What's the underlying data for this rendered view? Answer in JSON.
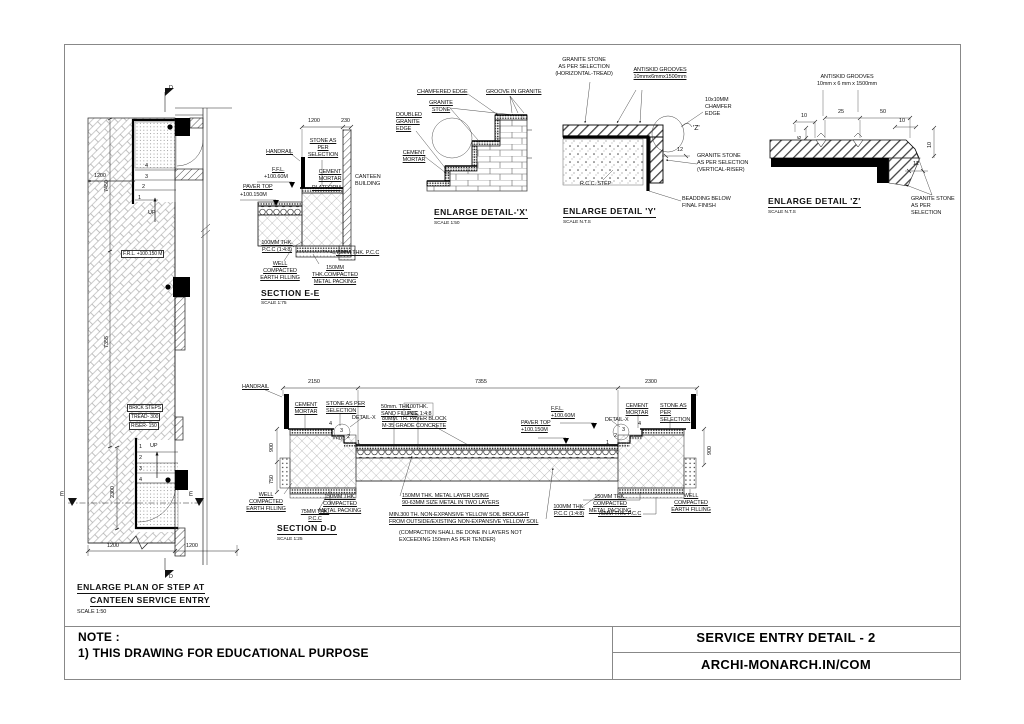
{
  "note": {
    "heading": "NOTE :",
    "line1": "1) THIS DRAWING FOR EDUCATIONAL PURPOSE"
  },
  "titleblock": {
    "title": "SERVICE ENTRY DETAIL - 2",
    "website": "ARCHI-MONARCH.IN/COM"
  },
  "plan": {
    "title1": "ENLARGE PLAN OF STEP AT",
    "title2": "CANTEEN SERVICE ENTRY",
    "scale": "SCALE 1:50",
    "d_top": "D",
    "d_bottom": "D",
    "e_left": "E",
    "e_right": "E",
    "dim_7450": "7450",
    "dim_1200": "1200",
    "dim_7355": "7355",
    "dim_2300": "2300",
    "dim_1200_a": "1200",
    "dim_1200_b": "1200",
    "up1": "UP",
    "up2": "UP",
    "frl": "F.R.L. +100.150 M",
    "brick": "BRICK STEPS",
    "tread": "TREAD- 300",
    "riser": "RISER- 150",
    "n1": "1",
    "n2": "2",
    "n3": "3",
    "n4": "4",
    "m1": "1",
    "m2": "2",
    "m3": "3",
    "m4": "4"
  },
  "see": {
    "title": "SECTION E-E",
    "scale": "SCALE 1:75",
    "dim1200": "1200",
    "dim230": "230",
    "handrail": "HANDRAIL",
    "stone": "STONE AS\nPER\nSELECTION",
    "ffl": "F.F.L.",
    "ffl_v": "+100.60M",
    "paver": "PAVER TOP",
    "paver_v": "+100.150M",
    "cement": "CEMENT\nMORTAR",
    "platform": "PLATFORM",
    "canteen": "CANTEEN\nBUILDING",
    "pcc100": "100MM THK.\nP.C.C (1:4:8)",
    "earth": "WELL COMPACTED\nEARTH FILLING",
    "pcc75": "75MM THK. P.C.C",
    "metal": "150MM THK.COMPACTED\nMETAL PACKING"
  },
  "dx": {
    "title": "ENLARGE DETAIL-'X'",
    "scale": "SCALE 1:50",
    "chamfered": "CHAMFERED EDGE",
    "groove": "GROOVE IN GRANITE",
    "granite": "GRANITE\nSTONE",
    "doubled": "DOUBLED\nGRANITE\nEDGE",
    "cement": "CEMENT\nMORTAR"
  },
  "dy": {
    "title": "ENLARGE DETAIL 'Y'",
    "scale": "SCALE N.T.S",
    "granite_h": "GRANITE STONE\nAS PER SELECTION\n(HORIZONTAL-TREAD)",
    "antiskid": "ANTISKID GROOVES\n10mmx6mmx1500mm",
    "chamfer": "10x10MM\nCHAMFER\nEDGE",
    "z": "'Z'",
    "d12": "12",
    "granite_v": "GRANITE STONE\nAS PER SELECTION\n(VERTICAL-RISER)",
    "rcc": "R.C.C. STEP",
    "beading": "BEADDING BELOW\nFINAL FINISH"
  },
  "dz": {
    "title": "ENLARGE DETAIL 'Z'",
    "scale": "SCALE N.T.S",
    "antiskid": "ANTISKID GROOVES\n10mm x 6 mm x 1500mm",
    "d10a": "10",
    "d25": "25",
    "d50": "50",
    "d10b": "10",
    "d6": "6",
    "d10c": "10",
    "d12": "12",
    "granite": "GRANITE STONE\nAS PER\nSELECTION"
  },
  "sdd": {
    "title": "SECTION D-D",
    "scale": "SCALE 1:25",
    "dim2150": "2150",
    "dim7355": "7355",
    "dim2300": "2300",
    "handrail": "HANDRAIL",
    "cement_l": "CEMENT\nMORTAR",
    "stone_l": "STONE AS PER\nSELECTION",
    "detx_l": "DETAIL-X",
    "sand": "50mm. THK.\nSAND FILLING",
    "pcc100t": "100THK.\nPCC 1:4:8",
    "paver_block": "80MM. TH. PAVER BLOCK\nM-35 GRADE CONCRETE",
    "ffl": "F.F.L.\n+100.60M",
    "paver_top": "PAVER TOP\n+100.150M",
    "detx_r": "DETAIL-X",
    "cement_r": "CEMENT\nMORTAR",
    "stone_r": "STONE AS\nPER\nSELECTION",
    "d900l": "900",
    "d750": "750",
    "d900r": "900",
    "earth_l": "WELL COMPACTED\nEARTH FILLING",
    "metal_l": "150MM THK. COMPACTED\nMETAL PACKING",
    "pcc75l": "75MM THK.\nP.C.C",
    "metal_layer": "150MM THK. METAL LAYER USING\n90-63MM SIZE METAL IN TWO LAYERS",
    "soil": "MIN.300 TH. NON-EXPANSIVE YELLOW SOIL BROUGHT\nFROM OUTSIDE/EXISTING NON-EXPANSIVE YELLOW SOIL",
    "compaction": "(COMPACTION SHALL BE DONE IN LAYERS NOT\nEXCEEDING 150mm AS PER TENDER)",
    "pcc100b": "100MM THK.\nP.C.C (1:4:8)",
    "metal_r": "150MM THK. COMPACTED\nMETAL PACKING",
    "pcc75r": "75MM THK. P.C.C",
    "earth_r": "WELL COMPACTED\nEARTH FILLING",
    "l1": "1",
    "l2": "2",
    "l3": "3",
    "l4": "4",
    "r1": "1",
    "r2": "2",
    "r3": "3",
    "r4": "4"
  }
}
